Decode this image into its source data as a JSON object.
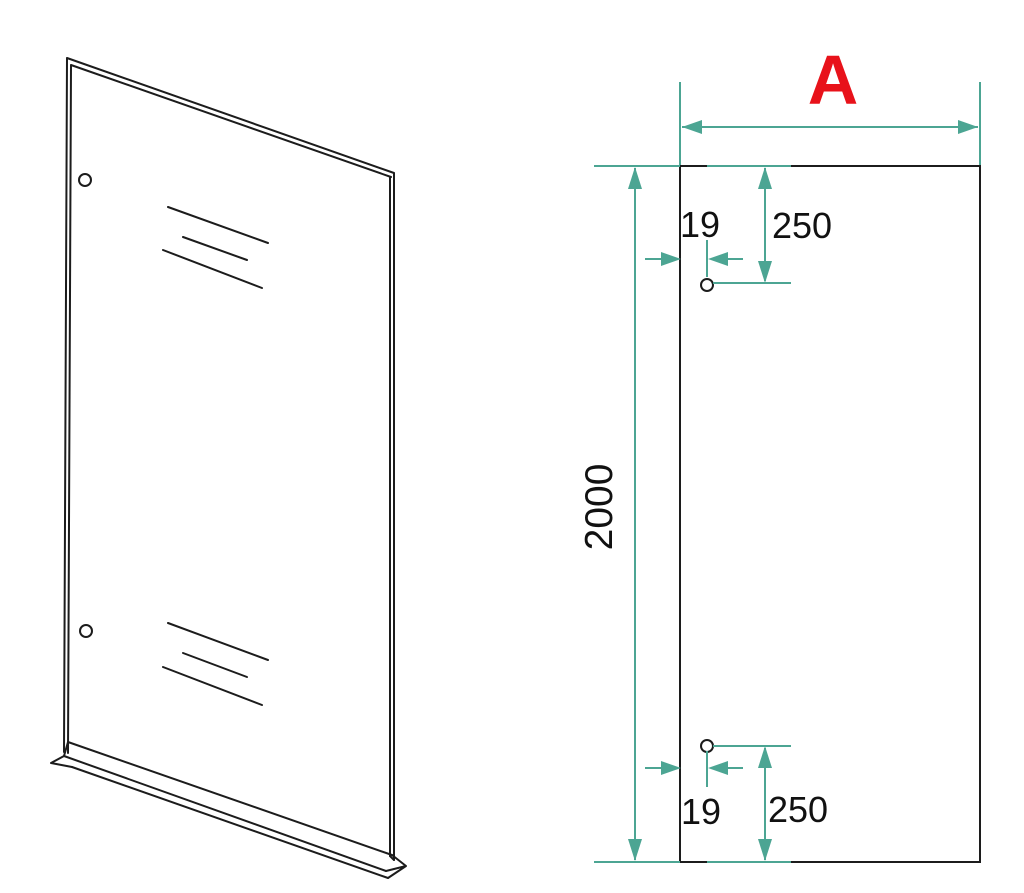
{
  "colors": {
    "outline": "#1c1c1c",
    "text": "#111111",
    "dimension": "#4ca593",
    "highlight_label": "#e8121a",
    "background": "#ffffff"
  },
  "front_view": {
    "width_label": "A",
    "height_label": "2000",
    "top_hole": {
      "edge_offset_label": "19",
      "top_offset_label": "250"
    },
    "bottom_hole": {
      "edge_offset_label": "19",
      "bottom_offset_label": "250"
    }
  }
}
